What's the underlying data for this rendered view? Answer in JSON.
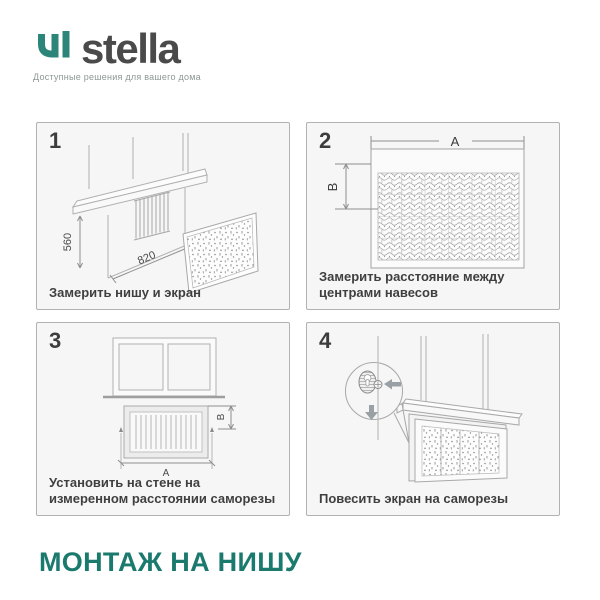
{
  "header": {
    "brand": "stella",
    "tagline": "Доступные решения для вашего дома"
  },
  "steps": [
    {
      "number": "1",
      "caption": "Замерить нишу и экран",
      "labels": {
        "height": "560",
        "width": "820"
      }
    },
    {
      "number": "2",
      "caption": "Замерить расстояние между центрами навесов",
      "labels": {
        "a": "A",
        "b": "B"
      }
    },
    {
      "number": "3",
      "caption": "Установить на стене на измеренном расстоянии саморезы",
      "labels": {
        "a": "A",
        "b": "B"
      }
    },
    {
      "number": "4",
      "caption": "Повесить экран на саморезы"
    }
  ],
  "footer": {
    "title": "МОНТАЖ НА НИШУ"
  },
  "colors": {
    "accent_teal": "#1b7a6e",
    "logo_teal": "#2b8578",
    "caption_text": "#3f3f3f",
    "line_art": "#adadad"
  }
}
